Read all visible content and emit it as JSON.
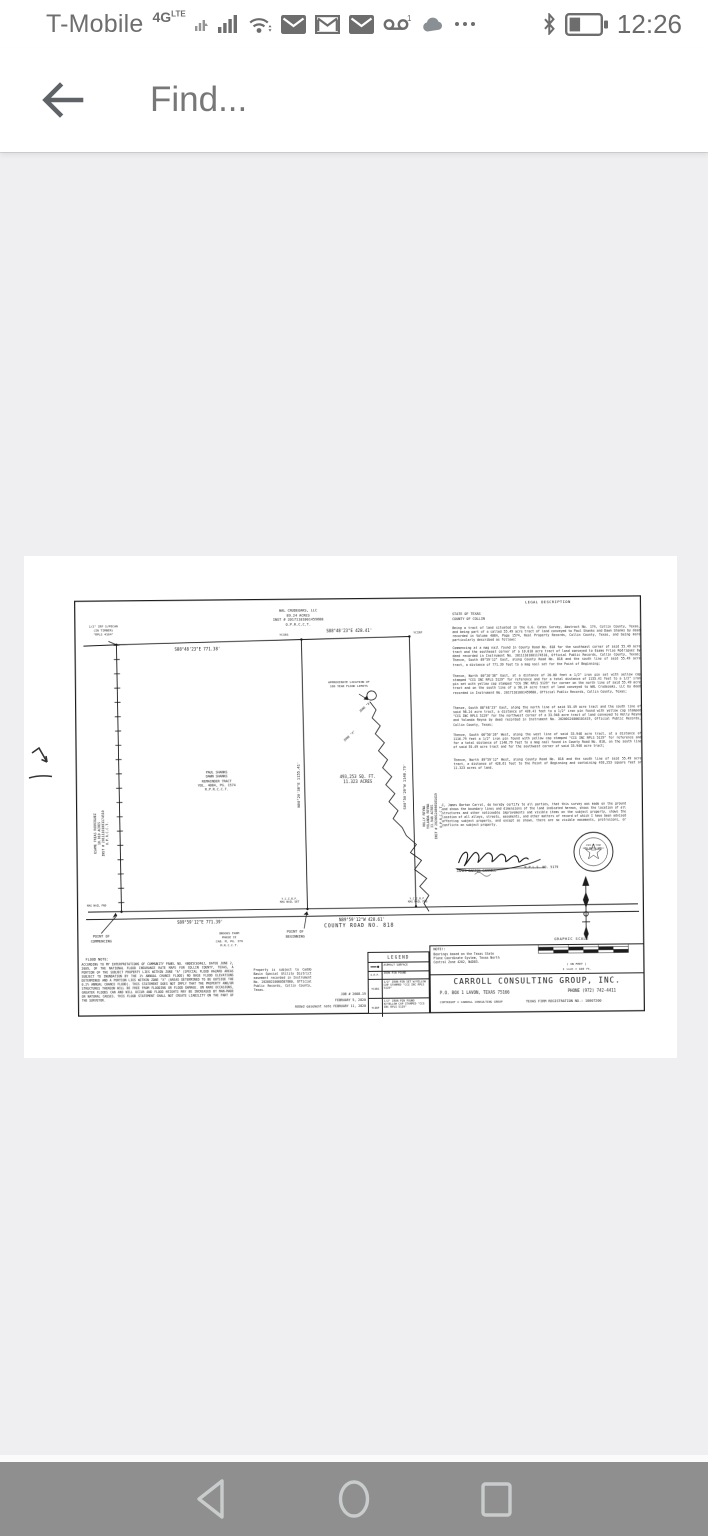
{
  "colors": {
    "content_background": "#efeff1",
    "nav_bar_background": "#8f8f8f",
    "status_icon_gray": "#6d6d6d",
    "toolbar_text_gray": "#777777",
    "plat_ink": "#161616"
  },
  "status_bar": {
    "carrier": "T-Mobile",
    "network": "4G",
    "network_sub": "LTE",
    "voicemail_badge": "1",
    "time": "12:26",
    "notification_icons": [
      "secondary-signal",
      "signal-strength",
      "wifi",
      "email",
      "gmail",
      "email",
      "voicemail",
      "cloud",
      "more"
    ]
  },
  "toolbar": {
    "find_placeholder": "Find..."
  },
  "nav_bar": {
    "buttons": [
      "back",
      "home",
      "recents"
    ]
  },
  "survey": {
    "owner_north": [
      "WAL CRUDEOAKS, LLC",
      "89.24 ACRES",
      "INST # 20171101001459680",
      "O.P.R.C.C.T."
    ],
    "nw_monument": [
      "1/2\" IRF S/PECAN",
      "(IN TIMBER)",
      "\"RPLS 4104\""
    ],
    "dims": {
      "north_west": "S88°48'23\"E  771.38'",
      "north_east": "S88°48'23\"E  428.41'",
      "west_interior": "N00°20'38\"E  1155.41'",
      "east": "S00°50'26\"W  1148.79'",
      "road_west": "S89°59'12\"E  771.39'",
      "road_east": "N89°59'12\"W  428.61'"
    },
    "pins": {
      "ycirs": "YCIRS",
      "ycirf": "YCIRF",
      "ycirf_road": "Y.C.I.R.F.",
      "mag_fnd": "MAG NAIL FND",
      "mag_set": "MAG NAIL SET"
    },
    "owner_west": [
      "ESAME FRIAS RODRIGUEZ",
      "10.010 ACRES",
      "INST # 20111101001174510",
      "O.P.R.C.C.T."
    ],
    "owner_east": [
      "HOLLY REYNA",
      "YOLANDA REYNA",
      "33.948 ACRES",
      "INST # 20200124000101419",
      "O.P.R.C.C.T."
    ],
    "subject_tract": [
      "PAUL SHANKS",
      "DAWN SHANKS",
      "REMAINDER TRACT",
      "VOL. 4084, PG. 1574",
      "R.P.R.C.C.T."
    ],
    "area": [
      "493,253 SQ. FT.",
      "11.323 ACRES"
    ],
    "flood_limit_label": [
      "APPROXIMATE LOCATION OF",
      "100 YEAR FLOOD LIMITS"
    ],
    "zones": {
      "a": "ZONE \"A\"",
      "x": "ZONE \"X\""
    },
    "road_name": "COUNTY ROAD NO. 818",
    "poc": [
      "POINT OF",
      "COMMENCING"
    ],
    "pob": [
      "POINT OF",
      "BEGINNING"
    ],
    "brooks_farm": [
      "BROOKS FARM",
      "PHASE II",
      "CAB. M, PG. 379",
      "M.R.C.C.T."
    ],
    "legal": {
      "title": "LEGAL DESCRIPTION",
      "state": "STATE OF TEXAS",
      "county": "COUNTY OF COLLIN",
      "paragraphs": [
        "Being a tract of land situated in the G.G. Cates Survey, Abstract No. 174, Collin County, Texas, and being part of a called 55.49 acre tract of land conveyed to Paul Shanks and Dawn Shanks by deed recorded in Volume 4084, Page 1574, Real Property Records, Collin County, Texas, and being more particularly described as follows:",
        "Commencing at a mag nail found in County Road No. 818 for the southeast corner of said 55.49 acre tract and the southeast corner of a 10.010 acre tract of land conveyed to Esame Frias Rodriguez by deed recorded in Instrument No. 20111101001174510, Official Public Records, Collin County, Texas; Thence, South 89°59'12\" East, along County Road No. 818 and the south line of said 55.49 acre tract, a distance of 771.39 feet to a mag nail set for the Point of Beginning;",
        "Thence, North 00°20'38\" East, at a distance of 20.00 feet a 1/2\" iron pin set with yellow cap stamped \"CCG INC RPLS 5129\" for reference and for a total distance of 1155.41 feet to a 1/2\" iron pin set with yellow cap stamped \"CCG INC RPLS 5129\" for corner on the north line of said 55.49 acre tract and on the south line of a 98.24 acre tract of land conveyed to WAL Crudeoaks, LLC by deed recorded in Instrument No. 20171101001459680, Official Public Records, Collin County, Texas;",
        "Thence, South 88°48'23\" East, along the north line of said 55.49 acre tract and the south line of said 98.24 acre tract, a distance of 428.41 feet to a 1/2\" iron pin found with yellow cap stamped \"CCG INC RPLS 5129\" for the northwest corner of a 33.948 acre tract of land conveyed to Holly Reyna and Yolanda Reyna by deed recorded in Instrument No. 20200124000101419, Official Public Records, Collin County, Texas;",
        "Thence, South 00°50'26\" West, along the west line of said 33.948 acre tract, at a distance of 1116.79 feet a 1/2\" iron pin found with yellow cap stamped \"CCG INC RPLS 5129\" for reference and for a total distance of 1148.79 feet to a mag nail found in County Road No. 818, on the south line of said 55.49 acre tract and for the southwest corner of said 33.948 acre tract;",
        "Thence, North 89°59'12\" West, along County Road No. 818 and the south line of said 55.49 acre tract, a distance of 428.61 feet to the Point of Beginning and containing 493,253 square feet or 11.323 acres of land."
      ]
    },
    "certification": "I, James Barton Carrol, do hereby certify to all parties, that this survey was made on the ground and shows the boundary lines and dimensions of the land indicated hereon, shows the location of all structures and other noticeable improvements and visible items on the subject property, shows the location of all alleys, streets, easements, and other matters of record of which I have been advised affecting subject property, and except as shown, there are no visible easements, protrusions, or conflicts on subject property.",
    "signature": {
      "name": "JAMES BARTON CARROLL",
      "rpls": "R.P.L.S. NO. 5179"
    },
    "seal_text": [
      "STATE OF TEXAS",
      "JAMES BARTON CARROLL",
      "5129"
    ],
    "flood_note": {
      "title": "FLOOD NOTE:",
      "body": "ACCORDING TO MY INTERPRETATIONS OF COMMUNITY PANEL NO. 48085C0340J, DATED JUNE 2, 2009, OF THE NATIONAL FLOOD INSURANCE RATE MAPS FOR COLLIN COUNTY, TEXAS, A PORTION OF THE SUBJECT PROPERTY LIES WITHIN ZONE \"A\" (SPECIAL FLOOD HAZARD AREAS SUBJECT TO INUNDATION BY THE 1% ANNUAL CHANCE FLOOD) NO BASE FLOOD ELEVATIONS DETERMINED AND A PORTION LIES WITHIN ZONE \"X\" (AREAS DETERMINED TO BE OUTSIDE THE 0.2% ANNUAL CHANCE FLOOD). THIS STATEMENT DOES NOT IMPLY THAT THE PROPERTY AND/OR STRUCTURES THEREON WILL BE FREE FROM FLOODING OR FLOOD DAMAGE. ON RARE OCCASIONS, GREATER FLOODS CAN AND WILL OCCUR AND FLOOD HEIGHTS MAY BE INCREASED BY MAN-MADE OR NATURAL CAUSES. THIS FLOOD STATEMENT SHALL NOT CREATE LIABILITY ON THE PART OF THE SURVEYOR.",
      "easement": "Property is subject to Caddo Basin Special Utility District easement recorded in Instrument No. 20200210000587800, Official Public Records, Collin County, Texas."
    },
    "job_notes": [
      "JOB # 2608-19",
      "FEBRUARY 5, 2020",
      "Added easement note FEBRUARY 11, 2020"
    ],
    "legend": {
      "title": "LEGEND",
      "rows": [
        {
          "symbol": "",
          "label": "ASPHALT SURFACE"
        },
        {
          "symbol": "I.P.F.",
          "label": "IRON PIN FOUND"
        },
        {
          "symbol": "YCIRS",
          "label": "1/2\" IRON PIN SET W/YELLOW CAP STAMPED \"CCG INC RPLS 5129\""
        },
        {
          "symbol": "YCIRF",
          "label": "1/2\" IRON PIN FOUND W/YELLOW CAP STAMPED \"CCG INC RPLS 5129\""
        }
      ]
    },
    "bearing_note": {
      "title": "NOTE!:",
      "body": "Bearings based on the Texas State Plane Coordinate System, Texas North Central Zone 4202, NAD83."
    },
    "firm": {
      "name": "CARROLL CONSULTING GROUP, INC.",
      "address": "P.O. BOX 1   LAVON, TEXAS  75166",
      "phone": "PHONE (972) 742-4411",
      "copyright": "COPYRIGHT ©  CARROLL CONSULTING GROUP",
      "registration": "TEXAS FIRM REGISTRATION NO.: 10007200"
    },
    "graphic_scale": {
      "title": "GRAPHIC SCALE",
      "in_feet": "( IN FEET )",
      "ratio": "1 inch = 100 ft."
    }
  }
}
